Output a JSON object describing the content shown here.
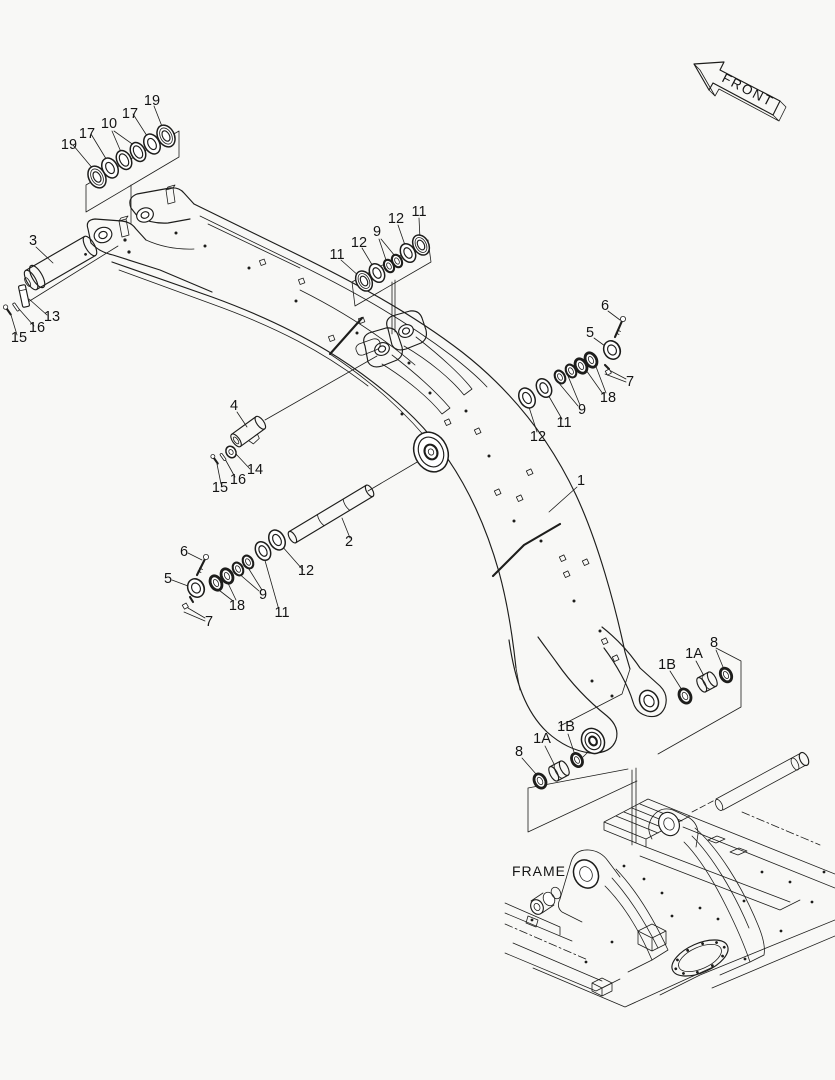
{
  "labels": {
    "front": "FRONT",
    "frame": "FRAME"
  },
  "colors": {
    "background": "#f8f8f6",
    "line": "#1d1d1b"
  },
  "callouts": [
    "19",
    "17",
    "10",
    "17",
    "19",
    "3",
    "13",
    "16",
    "15",
    "11",
    "12",
    "9",
    "12",
    "11",
    "6",
    "5",
    "7",
    "18",
    "9",
    "11",
    "12",
    "4",
    "14",
    "16",
    "15",
    "1",
    "2",
    "6",
    "5",
    "18",
    "9",
    "11",
    "12",
    "7",
    "1B",
    "1A",
    "8",
    "8",
    "1A",
    "1B"
  ]
}
